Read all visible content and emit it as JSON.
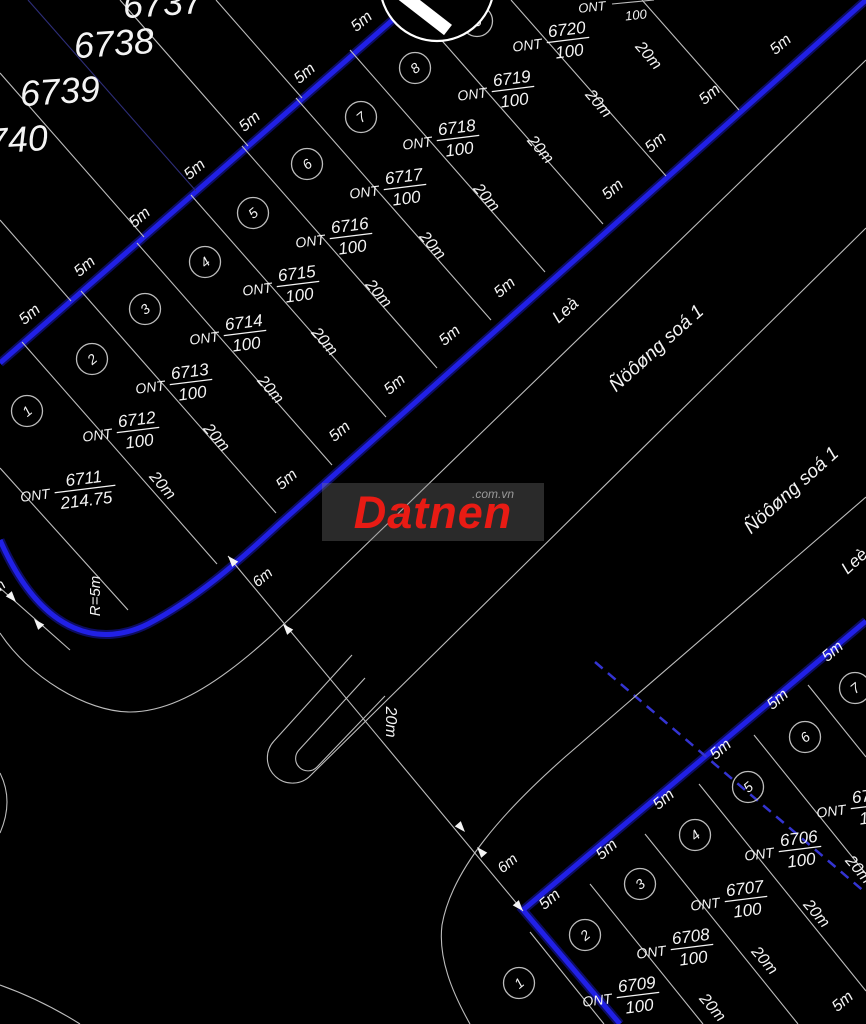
{
  "watermark": {
    "brand": "Datnen",
    "suffix": ".com.vn",
    "box": {
      "x": 322,
      "y": 483,
      "w": 222,
      "h": 58
    },
    "brand_color": "#e81b14",
    "box_bg": "rgba(130,130,130,0.32)",
    "suffix_color": "#9a9a9a",
    "suffix_pos": {
      "x": 150,
      "y": 4
    }
  },
  "map": {
    "width": 866,
    "height": 1024,
    "colors": {
      "bg": "#000000",
      "road": "#2120e6",
      "road_glow": "#12128a",
      "road_dash": "#3434d2",
      "line": "#bdbdbd",
      "faint_blue_line": "#2e2e7a",
      "text": "#f4f4f4"
    },
    "roads": [
      {
        "name": "road-1-back-edge",
        "d": "M 420 -4 L 0 363",
        "w": 5
      },
      {
        "name": "road-1-front-edge",
        "d": "M 866 0 L 278 525 C 238 562 196 599 148 624 C 104 646 44 640 0 540",
        "w": 5
      },
      {
        "name": "road-2-edge",
        "d": "M 620 1024 L 523 910 L 866 621",
        "w": 5
      },
      {
        "name": "road-centerline-dashed",
        "d": "M 595 662 L 866 893",
        "w": 2.5,
        "dash": "10 7"
      }
    ],
    "white_paths": [
      {
        "name": "corridor-edge-1",
        "d": "M 866 60 L 345 565 C 272 636 200 712 130 712 C 86 712 28 676 0 633"
      },
      {
        "name": "corridor-edge-2-with-island-end",
        "d": "M 866 228 L 311 775 A 25 25 0 0 1 274 741 L 352 655"
      },
      {
        "name": "island-end-inner",
        "d": "M 385 696 L 317 767 A 12 12 0 0 1 299 750 L 365 678"
      },
      {
        "name": "road-2-nw-edge",
        "d": "M 866 497 L 565 757 C 505 810 452 868 442 925 C 438 958 452 992 470 1024"
      },
      {
        "name": "left-edge-arc",
        "d": "M 0 773 Q 14 801 0 833"
      },
      {
        "name": "bottom-left-arc",
        "d": "M 0 985 Q 42 1000 80 1024"
      },
      {
        "name": "dimension-chain-line",
        "d": "M 228 556 L 523 911"
      },
      {
        "name": "dimension-chain-left-partial",
        "d": "M 0 588 L 70 650"
      }
    ],
    "boundary_lines": [
      {
        "p": [
          216,
          0,
          302,
          98
        ]
      },
      {
        "p": [
          120,
          0,
          248,
          146
        ]
      },
      {
        "p": [
          28,
          0,
          196,
          191
        ],
        "faint": true
      },
      {
        "p": [
          0,
          73,
          144,
          237
        ]
      },
      {
        "p": [
          0,
          220,
          71,
          301
        ]
      },
      {
        "p": [
          0,
          468,
          128,
          610
        ]
      },
      {
        "p": [
          22,
          342,
          217,
          564
        ]
      },
      {
        "p": [
          81,
          291,
          276,
          513
        ]
      },
      {
        "p": [
          137,
          243,
          332,
          465
        ]
      },
      {
        "p": [
          191,
          195,
          386,
          417
        ]
      },
      {
        "p": [
          242,
          146,
          437,
          368
        ]
      },
      {
        "p": [
          296,
          98,
          491,
          320
        ]
      },
      {
        "p": [
          350,
          50,
          545,
          272
        ]
      },
      {
        "p": [
          408,
          2,
          603,
          224
        ]
      },
      {
        "p": [
          511,
          0,
          666,
          176
        ]
      },
      {
        "p": [
          642,
          0,
          739,
          110
        ]
      },
      {
        "p": [
          612,
          4,
          654,
          0
        ]
      },
      {
        "p": [
          530,
          932,
          604,
          1024
        ]
      },
      {
        "p": [
          590,
          884,
          703,
          1024
        ]
      },
      {
        "p": [
          645,
          834,
          798,
          1024
        ]
      },
      {
        "p": [
          699,
          784,
          866,
          991
        ]
      },
      {
        "p": [
          754,
          735,
          866,
          874
        ]
      },
      {
        "p": [
          808,
          685,
          866,
          757
        ]
      }
    ],
    "plot_numbers": [
      {
        "t": "6737",
        "x": 163,
        "y": 6,
        "r": -4,
        "s": 36
      },
      {
        "t": "6738",
        "x": 114,
        "y": 46,
        "r": -4,
        "s": 36
      },
      {
        "t": "6739",
        "x": 60,
        "y": 94,
        "r": -4,
        "s": 36
      },
      {
        "t": "6740",
        "x": 8,
        "y": 143,
        "r": -4,
        "s": 36
      }
    ],
    "dim_labels": [
      {
        "t": "5m",
        "x": 30,
        "y": 315,
        "r": -40,
        "s": 16
      },
      {
        "t": "5m",
        "x": 85,
        "y": 267,
        "r": -40,
        "s": 16
      },
      {
        "t": "5m",
        "x": 140,
        "y": 218,
        "r": -40,
        "s": 16
      },
      {
        "t": "5m",
        "x": 195,
        "y": 170,
        "r": -40,
        "s": 16
      },
      {
        "t": "5m",
        "x": 250,
        "y": 122,
        "r": -40,
        "s": 16
      },
      {
        "t": "5m",
        "x": 305,
        "y": 74,
        "r": -40,
        "s": 16
      },
      {
        "t": "5m",
        "x": 362,
        "y": 22,
        "r": -40,
        "s": 16
      },
      {
        "t": "5m",
        "x": 613,
        "y": 190,
        "r": -40,
        "s": 16
      },
      {
        "t": "5m",
        "x": 656,
        "y": 143,
        "r": -40,
        "s": 16
      },
      {
        "t": "5m",
        "x": 710,
        "y": 95,
        "r": -40,
        "s": 16
      },
      {
        "t": "5m",
        "x": 781,
        "y": 45,
        "r": -40,
        "s": 16
      },
      {
        "t": "5m",
        "x": 287,
        "y": 480,
        "r": -40,
        "s": 16
      },
      {
        "t": "5m",
        "x": 340,
        "y": 432,
        "r": -40,
        "s": 16
      },
      {
        "t": "5m",
        "x": 395,
        "y": 385,
        "r": -40,
        "s": 16
      },
      {
        "t": "5m",
        "x": 450,
        "y": 336,
        "r": -40,
        "s": 16
      },
      {
        "t": "5m",
        "x": 505,
        "y": 288,
        "r": -40,
        "s": 16
      },
      {
        "t": "5m",
        "x": 550,
        "y": 900,
        "r": -40,
        "s": 16
      },
      {
        "t": "5m",
        "x": 607,
        "y": 850,
        "r": -40,
        "s": 16
      },
      {
        "t": "5m",
        "x": 664,
        "y": 800,
        "r": -40,
        "s": 16
      },
      {
        "t": "5m",
        "x": 721,
        "y": 750,
        "r": -40,
        "s": 16
      },
      {
        "t": "5m",
        "x": 778,
        "y": 700,
        "r": -40,
        "s": 16
      },
      {
        "t": "5m",
        "x": 833,
        "y": 652,
        "r": -40,
        "s": 16
      },
      {
        "t": "5m",
        "x": 843,
        "y": 1002,
        "r": -40,
        "s": 16
      },
      {
        "t": "20m",
        "x": 162,
        "y": 486,
        "r": 49,
        "s": 16
      },
      {
        "t": "20m",
        "x": 216,
        "y": 438,
        "r": 49,
        "s": 16
      },
      {
        "t": "20m",
        "x": 270,
        "y": 390,
        "r": 49,
        "s": 16
      },
      {
        "t": "20m",
        "x": 324,
        "y": 342,
        "r": 49,
        "s": 16
      },
      {
        "t": "20m",
        "x": 378,
        "y": 294,
        "r": 49,
        "s": 16
      },
      {
        "t": "20m",
        "x": 432,
        "y": 246,
        "r": 49,
        "s": 16
      },
      {
        "t": "20m",
        "x": 486,
        "y": 198,
        "r": 49,
        "s": 16
      },
      {
        "t": "20m",
        "x": 540,
        "y": 150,
        "r": 49,
        "s": 16
      },
      {
        "t": "20m",
        "x": 598,
        "y": 104,
        "r": 49,
        "s": 16
      },
      {
        "t": "20m",
        "x": 648,
        "y": 56,
        "r": 49,
        "s": 16
      },
      {
        "t": "20m",
        "x": 712,
        "y": 1008,
        "r": 49,
        "s": 16
      },
      {
        "t": "20m",
        "x": 764,
        "y": 961,
        "r": 49,
        "s": 16
      },
      {
        "t": "20m",
        "x": 816,
        "y": 914,
        "r": 49,
        "s": 16
      },
      {
        "t": "20m",
        "x": 858,
        "y": 870,
        "r": 49,
        "s": 16
      },
      {
        "t": "20m",
        "x": 390,
        "y": 722,
        "r": 90,
        "s": 16
      },
      {
        "t": "6m",
        "x": 263,
        "y": 578,
        "r": -40,
        "s": 15
      },
      {
        "t": "6m",
        "x": 508,
        "y": 864,
        "r": -40,
        "s": 15
      },
      {
        "t": "6m",
        "x": -4,
        "y": 590,
        "r": -40,
        "s": 15
      },
      {
        "t": "R=5m",
        "x": 96,
        "y": 596,
        "r": -90,
        "s": 15
      },
      {
        "t": "ONT",
        "x": 592,
        "y": 8,
        "r": -6,
        "s": 13
      },
      {
        "t": "100",
        "x": 636,
        "y": 16,
        "r": -6,
        "s": 13
      }
    ],
    "street_labels": [
      {
        "t": "Leà",
        "x": 566,
        "y": 311,
        "r": -42,
        "s": 17
      },
      {
        "t": "Ñöôøng soá 1",
        "x": 657,
        "y": 349,
        "r": -42,
        "s": 19
      },
      {
        "t": "Ñöôøng soá 1",
        "x": 792,
        "y": 491,
        "r": -42,
        "s": 19
      },
      {
        "t": "Leè",
        "x": 855,
        "y": 562,
        "r": -42,
        "s": 17
      }
    ],
    "ont_labels": [
      {
        "prefix": "ONT",
        "num": "6711",
        "den": "214.75",
        "x": 85,
        "y": 489,
        "r": -7
      },
      {
        "prefix": "ONT",
        "num": "6712",
        "den": "100",
        "x": 138,
        "y": 430,
        "r": -7
      },
      {
        "prefix": "ONT",
        "num": "6713",
        "den": "100",
        "x": 191,
        "y": 382,
        "r": -7
      },
      {
        "prefix": "ONT",
        "num": "6714",
        "den": "100",
        "x": 245,
        "y": 333,
        "r": -7
      },
      {
        "prefix": "ONT",
        "num": "6715",
        "den": "100",
        "x": 298,
        "y": 284,
        "r": -7
      },
      {
        "prefix": "ONT",
        "num": "6716",
        "den": "100",
        "x": 351,
        "y": 236,
        "r": -7
      },
      {
        "prefix": "ONT",
        "num": "6717",
        "den": "100",
        "x": 405,
        "y": 187,
        "r": -7
      },
      {
        "prefix": "ONT",
        "num": "6718",
        "den": "100",
        "x": 458,
        "y": 138,
        "r": -7
      },
      {
        "prefix": "ONT",
        "num": "6719",
        "den": "100",
        "x": 513,
        "y": 89,
        "r": -7
      },
      {
        "prefix": "ONT",
        "num": "6720",
        "den": "100",
        "x": 568,
        "y": 40,
        "r": -7
      },
      {
        "prefix": "ONT",
        "num": "6709",
        "den": "100",
        "x": 638,
        "y": 995,
        "r": -7
      },
      {
        "prefix": "ONT",
        "num": "6708",
        "den": "100",
        "x": 692,
        "y": 947,
        "r": -7
      },
      {
        "prefix": "ONT",
        "num": "6707",
        "den": "100",
        "x": 746,
        "y": 899,
        "r": -7
      },
      {
        "prefix": "ONT",
        "num": "6706",
        "den": "100",
        "x": 800,
        "y": 849,
        "r": -7
      },
      {
        "prefix": "ONT",
        "num": "6705",
        "den": "100",
        "x": 872,
        "y": 806,
        "r": -7
      }
    ],
    "parcel_badges": [
      {
        "n": "1",
        "x": 27,
        "y": 411
      },
      {
        "n": "2",
        "x": 92,
        "y": 359
      },
      {
        "n": "3",
        "x": 145,
        "y": 309
      },
      {
        "n": "4",
        "x": 205,
        "y": 262
      },
      {
        "n": "5",
        "x": 253,
        "y": 213
      },
      {
        "n": "6",
        "x": 307,
        "y": 164
      },
      {
        "n": "7",
        "x": 361,
        "y": 117
      },
      {
        "n": "8",
        "x": 415,
        "y": 68
      },
      {
        "n": "9",
        "x": 477,
        "y": 21
      },
      {
        "n": "1",
        "x": 519,
        "y": 983
      },
      {
        "n": "2",
        "x": 585,
        "y": 935
      },
      {
        "n": "3",
        "x": 640,
        "y": 884
      },
      {
        "n": "4",
        "x": 695,
        "y": 835
      },
      {
        "n": "5",
        "x": 748,
        "y": 787
      },
      {
        "n": "6",
        "x": 805,
        "y": 737
      },
      {
        "n": "7",
        "x": 855,
        "y": 688
      }
    ],
    "arrows": [
      {
        "x": 228,
        "y": 556,
        "a": -131
      },
      {
        "x": 283,
        "y": 624,
        "a": -131
      },
      {
        "x": 465,
        "y": 832,
        "a": 49
      },
      {
        "x": 477,
        "y": 847,
        "a": -131
      },
      {
        "x": 523,
        "y": 911,
        "a": 49
      },
      {
        "x": 16,
        "y": 602,
        "a": 49
      },
      {
        "x": 34,
        "y": 619,
        "a": -131
      }
    ],
    "symbol": {
      "cx": 437,
      "cy": -16,
      "r": 57,
      "bar": [
        399,
        -8,
        448,
        30
      ],
      "badge": {
        "n": "9",
        "x": 477,
        "y": 21
      }
    }
  }
}
